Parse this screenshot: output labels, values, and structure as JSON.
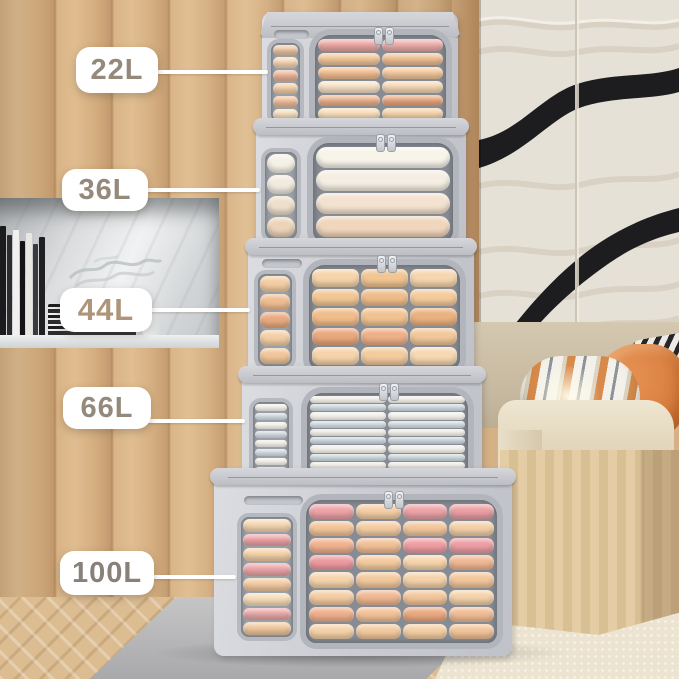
{
  "labels": [
    {
      "text": "22L"
    },
    {
      "text": "36L"
    },
    {
      "text": "44L"
    },
    {
      "text": "66L"
    },
    {
      "text": "100L"
    }
  ],
  "label_style": {
    "background": "#ffffff",
    "text_color": "#95897b",
    "leader_color": "#ffffff"
  },
  "boxes": [
    {
      "capacity_label": "22L",
      "has_handle": true,
      "front": {
        "cols": 2,
        "rows": [
          [
            "#efaaa6",
            "#f0b0ad"
          ],
          [
            "#f4c89c",
            "#f2c196"
          ],
          [
            "#f3c093",
            "#f5cba0"
          ],
          [
            "#f8e3c6",
            "#f6d9b6"
          ],
          [
            "#edb28c",
            "#e9a87f"
          ],
          [
            "#f7dcb9",
            "#f4d2a9"
          ]
        ]
      },
      "side": {
        "rows": [
          "#f2c9a4",
          "#f6d8b4",
          "#eeb79a",
          "#f4cfa8",
          "#efc09c",
          "#f7ddbb"
        ]
      }
    },
    {
      "capacity_label": "36L",
      "has_handle": false,
      "front": {
        "cols": 1,
        "rows": [
          "#f8f4ea",
          "#f4eee3",
          "#f3e2cf",
          "#f0d6bd"
        ]
      },
      "side": {
        "rows": [
          "#f6f1e7",
          "#f1ebdf",
          "#eedfcc",
          "#ecd4ba"
        ]
      }
    },
    {
      "capacity_label": "44L",
      "has_handle": true,
      "front": {
        "cols": 3,
        "rows": [
          [
            "#f6d4ab",
            "#f2c693",
            "#f6d6ae"
          ],
          [
            "#f3c795",
            "#efbd8b",
            "#f4cb9c"
          ],
          [
            "#f0bd8b",
            "#f2c392",
            "#eab27f"
          ],
          [
            "#e9a87d",
            "#eeb088",
            "#f2c89a"
          ],
          [
            "#f5d3ab",
            "#f3cb9e",
            "#f6d8b2"
          ]
        ]
      },
      "side": {
        "rows": [
          "#f4cda3",
          "#efbd92",
          "#e9aa80",
          "#f3cfa6",
          "#f1c69b"
        ]
      }
    },
    {
      "capacity_label": "66L",
      "has_handle": false,
      "front": {
        "cols": 2,
        "rows": [
          "#f2efe8",
          "#ccd7dd",
          "#f3f0e9",
          "#d0dade",
          "#efece4",
          "#c9d4da",
          "#f2efe8",
          "#ccd6dc",
          "#eeebe3",
          "#cfd8dd",
          "#f1eee7",
          "#cbd5db"
        ]
      },
      "side": {
        "rows": [
          "#f1eee7",
          "#ced8de",
          "#f3f0e9",
          "#ccd6dc",
          "#efece4",
          "#d0dade",
          "#f2efe8",
          "#cbd5db",
          "#f0ede6",
          "#ced8de"
        ]
      }
    },
    {
      "capacity_label": "100L",
      "has_handle": true,
      "front": {
        "cols": 4,
        "rows": [
          [
            "#eda4a8",
            "#f5cfa6",
            "#eda4a8",
            "#eba0a5"
          ],
          [
            "#f3c59b",
            "#f4cda3",
            "#f2c79d",
            "#f4d0a8"
          ],
          [
            "#f0b391",
            "#f2c098",
            "#ef9fa3",
            "#ed9fa4"
          ],
          [
            "#ec9ba1",
            "#f4cb9f",
            "#f6d5ac",
            "#f0b894"
          ],
          [
            "#f6d5ad",
            "#f3c99e",
            "#f5d2aa",
            "#f2c79c"
          ],
          [
            "#f4cda4",
            "#f0b893",
            "#f3c79c",
            "#f5d3ab"
          ],
          [
            "#eeb08d",
            "#f2c298",
            "#e9a981",
            "#f0bd95"
          ],
          [
            "#f5d2a9",
            "#f3ca9f",
            "#f4cfa5",
            "#f1c49a"
          ]
        ]
      },
      "side": {
        "rows": [
          "#f6d8b2",
          "#eda4a8",
          "#f5d2a9",
          "#eca6a9",
          "#f3cba2",
          "#f6dcb8",
          "#eaa9a9",
          "#f2c9a0"
        ]
      }
    }
  ],
  "palette": {
    "box_fabric": "#c9cbd1",
    "box_trim": "#b3b6bd",
    "window_backing": "#878c94",
    "wood_wall": "#d2ac7e",
    "panel_base": "#e6e1d6",
    "panel_ribbon": "#1d1d1f",
    "headboard": "#cabda4",
    "pillow_orange": "#dd8647",
    "pillow_stripe_dark": "#26262a",
    "bed_wood": "#ddc49a",
    "rug": "#ece3d0",
    "mat": "#b5b4b6",
    "marble": "#e8eaeb",
    "floor_wood": "#dcbd92"
  },
  "decor": {
    "book_spines": [
      "#1b1b1d",
      "#2c2c2e",
      "#f2f0ec",
      "#141416",
      "#e9e7e2",
      "#3a3a3c",
      "#202023"
    ],
    "glass_outline": "#b9bfc2"
  }
}
